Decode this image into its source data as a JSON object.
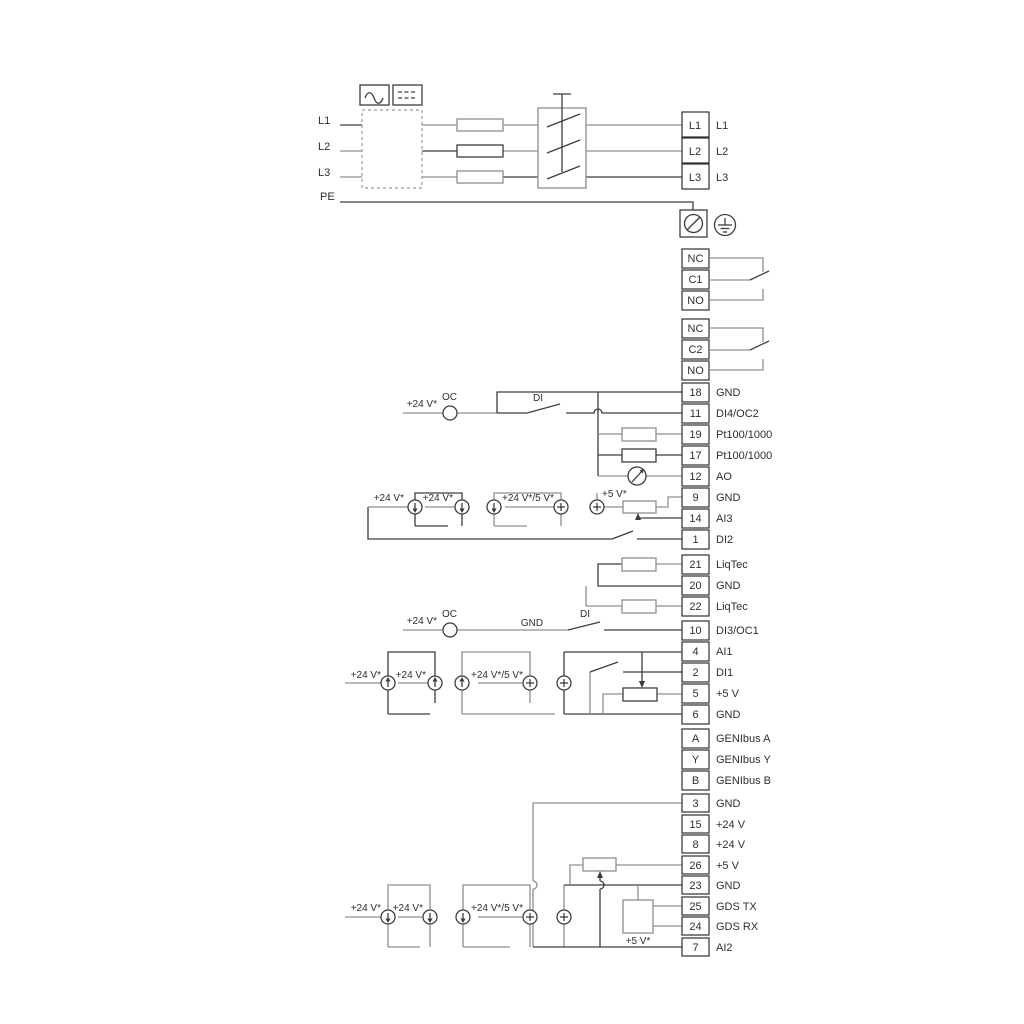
{
  "power": {
    "in_l1": "L1",
    "in_l2": "L2",
    "in_l3": "L3",
    "in_pe": "PE",
    "out_l1": "L1",
    "out_l2": "L2",
    "out_l3": "L3"
  },
  "relay1": {
    "nc": "NC",
    "c": "C1",
    "no": "NO"
  },
  "relay2": {
    "nc": "NC",
    "c": "C2",
    "no": "NO"
  },
  "terminals": {
    "t18": {
      "n": "18",
      "l": "GND"
    },
    "t11": {
      "n": "11",
      "l": "DI4/OC2"
    },
    "t19": {
      "n": "19",
      "l": "Pt100/1000"
    },
    "t17": {
      "n": "17",
      "l": "Pt100/1000"
    },
    "t12": {
      "n": "12",
      "l": "AO"
    },
    "t9": {
      "n": "9",
      "l": "GND"
    },
    "t14": {
      "n": "14",
      "l": "AI3"
    },
    "t1": {
      "n": "1",
      "l": "DI2"
    },
    "t21": {
      "n": "21",
      "l": "LiqTec"
    },
    "t20": {
      "n": "20",
      "l": "GND"
    },
    "t22": {
      "n": "22",
      "l": "LiqTec"
    },
    "t10": {
      "n": "10",
      "l": "DI3/OC1"
    },
    "t4": {
      "n": "4",
      "l": "AI1"
    },
    "t2": {
      "n": "2",
      "l": "DI1"
    },
    "t5": {
      "n": "5",
      "l": "+5 V"
    },
    "t6": {
      "n": "6",
      "l": "GND"
    },
    "ta": {
      "n": "A",
      "l": "GENIbus A"
    },
    "ty": {
      "n": "Y",
      "l": "GENIbus Y"
    },
    "tb": {
      "n": "B",
      "l": "GENIbus B"
    },
    "t3": {
      "n": "3",
      "l": "GND"
    },
    "t15": {
      "n": "15",
      "l": "+24 V"
    },
    "t8": {
      "n": "8",
      "l": "+24 V"
    },
    "t26": {
      "n": "26",
      "l": "+5 V"
    },
    "t23": {
      "n": "23",
      "l": "GND"
    },
    "t25": {
      "n": "25",
      "l": "GDS TX"
    },
    "t24": {
      "n": "24",
      "l": "GDS RX"
    },
    "t7": {
      "n": "7",
      "l": "AI2"
    }
  },
  "labels": {
    "v24": "+24 V*",
    "v24_5": "+24 V*/5 V*",
    "v5": "+5 V*",
    "oc": "OC",
    "di": "DI",
    "gnd": "GND"
  },
  "colors": {
    "wire_gray": "#8f8f8f",
    "wire_dark": "#3d3d3d",
    "text": "#2e2e2e"
  }
}
